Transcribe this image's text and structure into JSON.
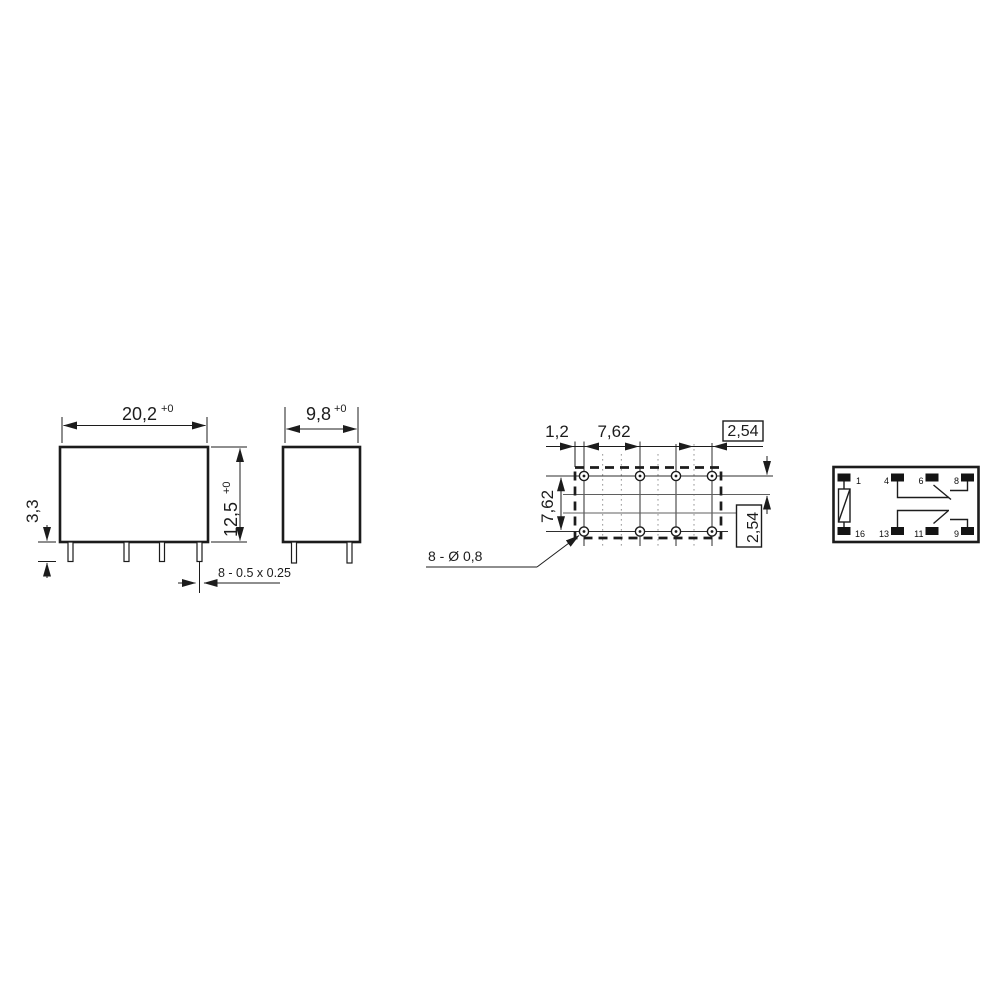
{
  "colors": {
    "ink": "#1c1c1c",
    "background": "#ffffff",
    "grid_line": "#8a8a8a"
  },
  "front_view": {
    "width": {
      "value": "20,2",
      "tol": "+0"
    },
    "height": {
      "value": "12,5",
      "tol": "+0"
    },
    "pin_length": "3,3",
    "pin_cross_section": "8 - 0.5 x 0.25"
  },
  "side_view": {
    "width": {
      "value": "9,8",
      "tol": "+0"
    }
  },
  "pcb_layout": {
    "edge_to_hole": "1,2",
    "hole_pitch": "7,62",
    "grid_pitch_top": "2,54",
    "row_pitch": "7,62",
    "grid_pitch_right": "2,54",
    "holes_label": "8 - Ø 0,8"
  },
  "schematic": {
    "pins_top": [
      "1",
      "4",
      "6",
      "8"
    ],
    "pins_bottom": [
      "16",
      "13",
      "11",
      "9"
    ]
  }
}
